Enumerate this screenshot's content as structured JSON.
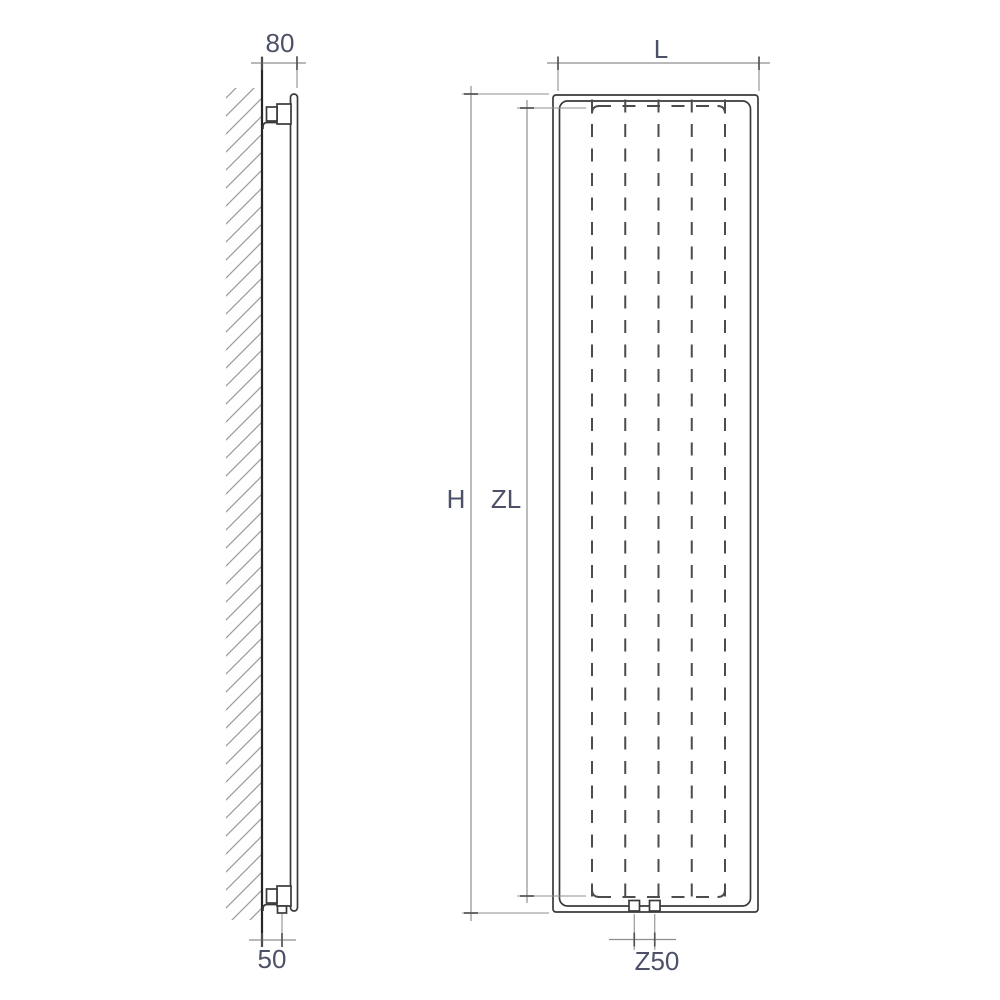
{
  "labels": {
    "depth": "80",
    "wall_distance": "50",
    "width": "L",
    "height": "H",
    "panel_height": "ZL",
    "connection_spacing": "Z50"
  },
  "colors": {
    "background": "#ffffff",
    "object_line": "#3a3a3a",
    "wall_line": "#262626",
    "dashed_line": "#4c4c4c",
    "dimension_line": "#8f8f8f",
    "tick": "#555555",
    "hatch": "#9a9a9a",
    "text": "#4d5168"
  }
}
